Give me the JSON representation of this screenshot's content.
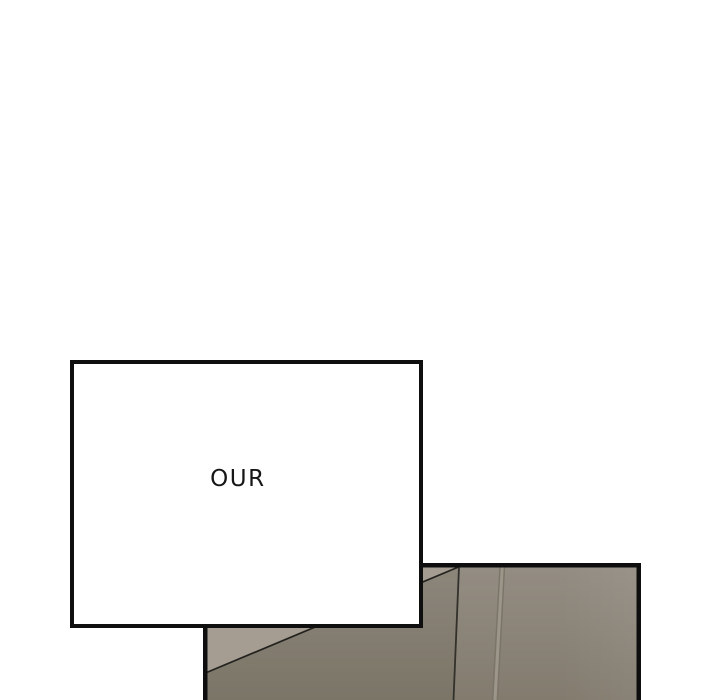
{
  "scene": {
    "background_color": "#ffffff",
    "speech_panel": {
      "text": "OUR",
      "fill_color": "#ffffff",
      "border_color": "#0f0f0f",
      "text_color": "#161616"
    },
    "artwork_panel": {
      "border_color": "#0e0e0e",
      "wall_light_color": "#a59d91",
      "wall_base_top_color": "#948d83",
      "wall_base_bottom_color": "#827b6e",
      "wall_shadow_overlay": "rgba(40,36,28,0.07)",
      "corner_edge_color": "#33312c",
      "seam_dark_color": "#7b7567",
      "seam_light_color": "#9c958a",
      "top_diagonal_color": "#23221f"
    }
  }
}
